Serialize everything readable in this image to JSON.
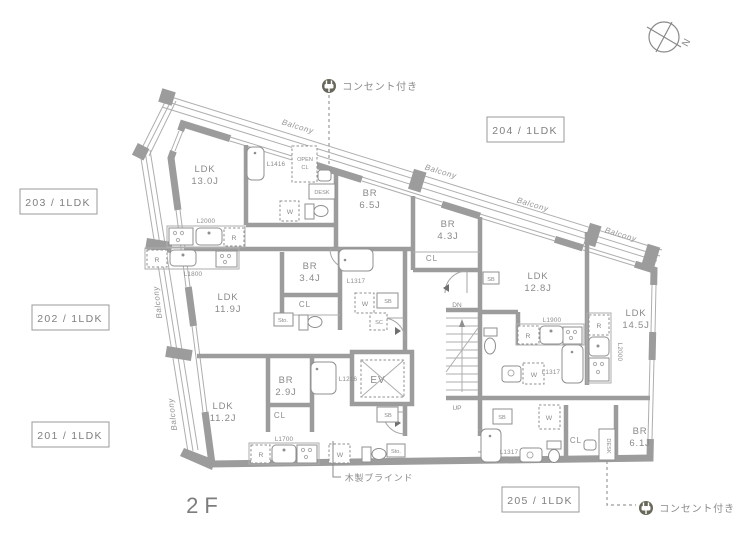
{
  "floor_label": "2F",
  "compass": {
    "n": "N"
  },
  "balcony_label": "Balcony",
  "unit_tags": {
    "u201": "201 / 1LDK",
    "u202": "202 / 1LDK",
    "u203": "203 / 1LDK",
    "u204": "204 / 1LDK",
    "u205": "205 / 1LDK"
  },
  "annotations": {
    "outlet_top": "コンセント付き",
    "outlet_bottom": "コンセント付き",
    "wood_blinds": "木製ブラインド"
  },
  "rooms": {
    "u203_ldk": {
      "name": "LDK",
      "size": "13.0J"
    },
    "u203_br": {
      "name": "BR",
      "size": "6.5J"
    },
    "u204_br": {
      "name": "BR",
      "size": "4.3J"
    },
    "u204_ldk": {
      "name": "LDK",
      "size": "12.8J"
    },
    "u205_ldk": {
      "name": "LDK",
      "size": "14.5J"
    },
    "u205_br": {
      "name": "BR",
      "size": "6.1J"
    },
    "u202_ldk": {
      "name": "LDK",
      "size": "11.9J"
    },
    "u202_br": {
      "name": "BR",
      "size": "3.4J"
    },
    "u201_ldk": {
      "name": "LDK",
      "size": "11.2J"
    },
    "u201_br": {
      "name": "BR",
      "size": "2.9J"
    }
  },
  "labels": {
    "cl": "CL",
    "open_cl_line1": "OPEN",
    "open_cl_line2": "CL",
    "desk": "DESK"
  },
  "codes": {
    "u203_bath": "L1416",
    "u203_kitchen": "L2000",
    "u202_kitchen": "L1800",
    "u202_bath": "L1317",
    "u201_kitchen": "L1700",
    "u201_bath": "L1216",
    "u204_kitchen": "L1900",
    "u204_bath": "L1317",
    "u205_kitchen": "L2000",
    "u205_bath": "L1317"
  },
  "equipment": {
    "r": "R",
    "w": "W",
    "sb": "SB",
    "sc": "SC",
    "sto": "Sto.",
    "ev": "EV",
    "up": "UP",
    "dn": "DN"
  }
}
